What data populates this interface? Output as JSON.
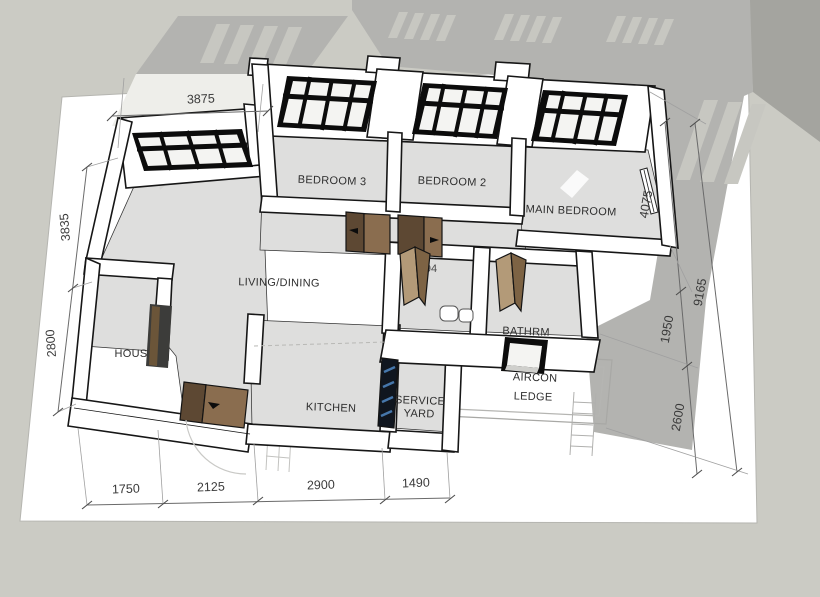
{
  "plan": {
    "view": "3d-floorplan-perspective",
    "room_labels": {
      "bedroom3": "BEDROOM 3",
      "bedroom2": "BEDROOM 2",
      "main_bedroom": "MAIN BEDROOM",
      "living_dining": "LIVING/DINING",
      "kitchen": "KITCHEN",
      "service_yard": [
        "SERVICE",
        "YARD"
      ],
      "aircon_ledge": [
        "AIRCON",
        "LEDGE"
      ],
      "household_shelter_fragment": "HOUS",
      "bathroom_fragment": "BATHRM"
    },
    "dimensions": {
      "top_width": "3875",
      "left_upper": "3835",
      "left_lower": "2800",
      "bottom_widths": [
        "1750",
        "2125",
        "2900",
        "1490"
      ],
      "right_total": "9165",
      "right_segments": [
        "4075",
        "1950",
        "2600"
      ],
      "partially_hidden": {
        "bedroom3_window_left": "3",
        "bedroom3_window_right": "50",
        "bedroom2_window": "00",
        "main_bedroom_window": "250",
        "bathroom1": "194",
        "bathroom2": "2"
      }
    },
    "colors": {
      "backdrop": "#cbcbc4",
      "backdrop_shadow": "#a4a49f",
      "page": "#ffffff",
      "cast_shadow": "#b3b3b0",
      "light_stripe": "#c7c7c1",
      "floor": "#dededd",
      "wall": "#ffffff",
      "wall_outline": "#161616",
      "door_wood_light": "#8a6d4f",
      "door_wood_dark": "#5d4833",
      "louver_blue": "#4677ab",
      "dimension_text": "#3a3a3a"
    }
  }
}
